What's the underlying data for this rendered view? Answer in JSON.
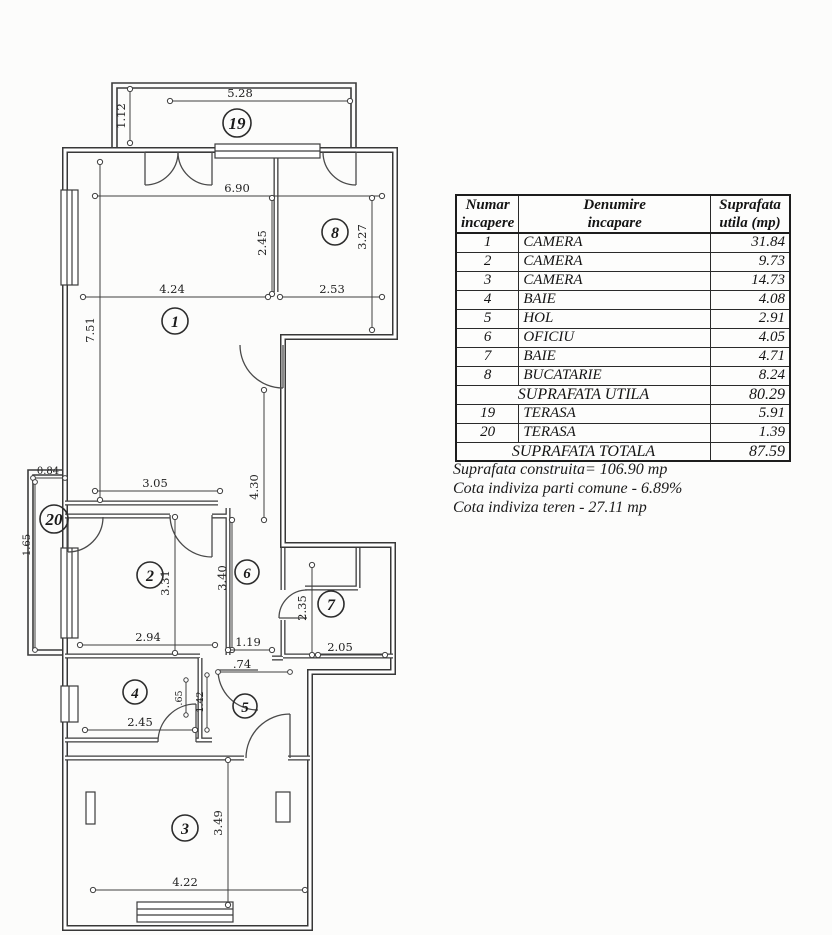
{
  "table": {
    "headers": [
      {
        "l1": "Numar",
        "l2": "incapere"
      },
      {
        "l1": "Denumire",
        "l2": "incapare"
      },
      {
        "l1": "Suprafata",
        "l2": "utila  (mp)"
      }
    ],
    "rows": [
      {
        "num": "1",
        "name": "CAMERA",
        "area": "31.84"
      },
      {
        "num": "2",
        "name": "CAMERA",
        "area": "9.73"
      },
      {
        "num": "3",
        "name": "CAMERA",
        "area": "14.73"
      },
      {
        "num": "4",
        "name": "BAIE",
        "area": "4.08"
      },
      {
        "num": "5",
        "name": "HOL",
        "area": "2.91"
      },
      {
        "num": "6",
        "name": "OFICIU",
        "area": "4.05"
      },
      {
        "num": "7",
        "name": "BAIE",
        "area": "4.71"
      },
      {
        "num": "8",
        "name": "BUCATARIE",
        "area": "8.24"
      }
    ],
    "suprafata_utila": {
      "label": "SUPRAFATA UTILA",
      "value": "80.29"
    },
    "terase": [
      {
        "num": "19",
        "name": "TERASA",
        "area": "5.91"
      },
      {
        "num": "20",
        "name": "TERASA",
        "area": "1.39"
      }
    ],
    "suprafata_totala": {
      "label": "SUPRAFATA TOTALA",
      "value": "87.59"
    }
  },
  "notes": {
    "construita": "Suprafata construita= 106.90 mp",
    "cota_comune": "Cota indiviza parti comune - 6.89%",
    "cota_teren": "Cota indiviza teren - 27.11 mp"
  },
  "plan": {
    "rooms": [
      {
        "number": "19"
      },
      {
        "number": "8"
      },
      {
        "number": "1"
      },
      {
        "number": "20"
      },
      {
        "number": "2"
      },
      {
        "number": "6"
      },
      {
        "number": "7"
      },
      {
        "number": "4"
      },
      {
        "number": "5"
      },
      {
        "number": "3"
      }
    ],
    "dims": [
      "5.28",
      "1.12",
      "6.90",
      "2.45",
      "3.27",
      "4.24",
      "2.53",
      "7.51",
      "3.05",
      "4.30",
      "0.84",
      "1.65",
      "3.31",
      "3.40",
      "2.94",
      "1.19",
      "2.35",
      "2.05",
      ".74",
      ".65",
      "1.42",
      "2.45",
      "3.49",
      "4.22"
    ]
  }
}
